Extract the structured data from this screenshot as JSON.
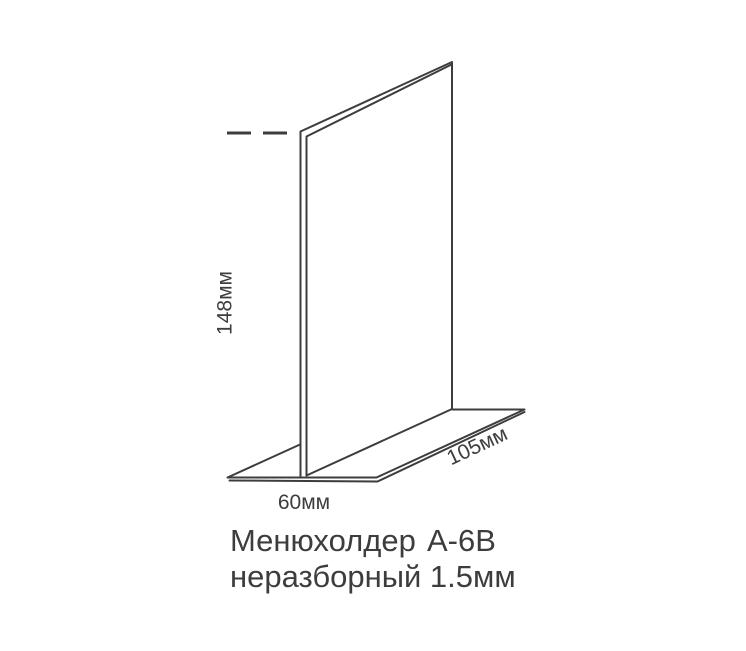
{
  "drawing": {
    "type": "product-dimension-diagram",
    "labels": {
      "height": "148мм",
      "base_depth": "60мм",
      "base_length": "105мм"
    },
    "caption": {
      "product": "Менюхолдер",
      "model": "А-6В",
      "subtitle": "неразборный 1.5мм"
    },
    "colors": {
      "line": "#3d3d3d",
      "text": "#3d3d3d",
      "background": "#ffffff"
    }
  }
}
